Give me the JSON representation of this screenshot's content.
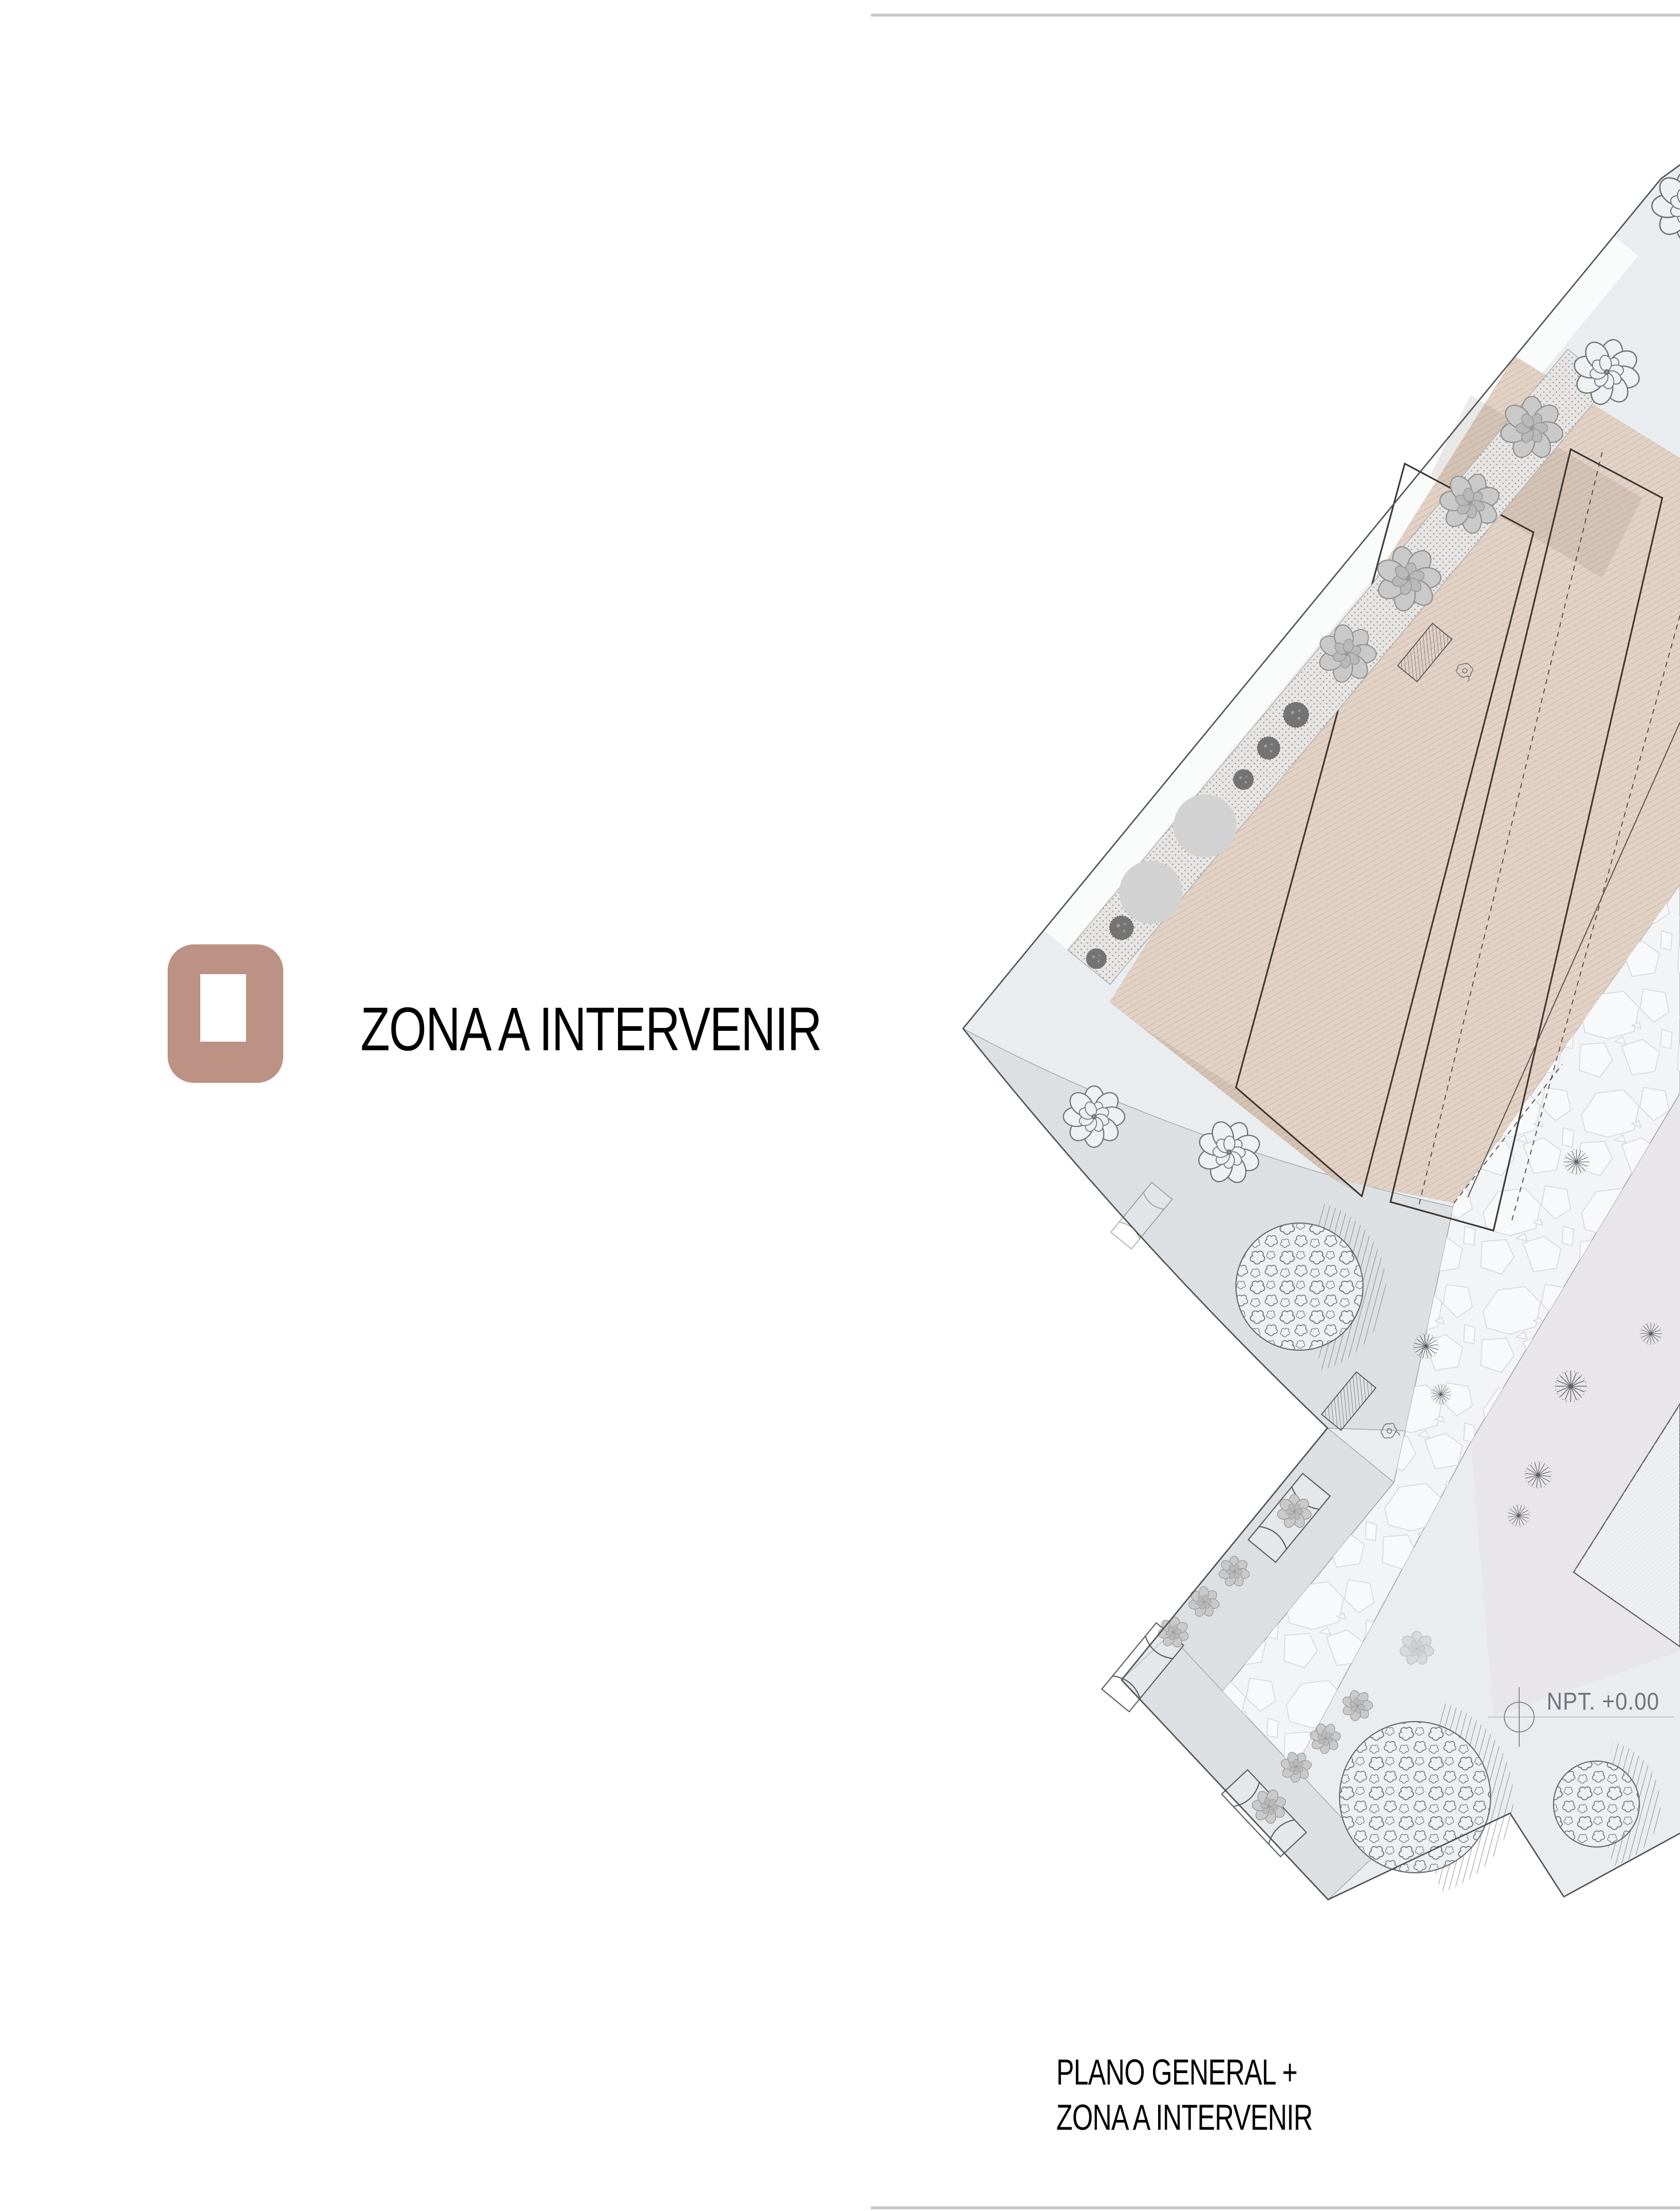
{
  "legend": {
    "zone_label": "ZONA A INTERVENIR",
    "swatch_color": "#bc9285"
  },
  "plan": {
    "npt_label": "NPT. +0.00"
  },
  "caption": {
    "line1": "PLANO GENERAL +",
    "line2": "ZONA A INTERVENIR"
  },
  "colors": {
    "accent": "#bc9285",
    "plaza": "#e9edf0",
    "walkway": "#dde0e3",
    "zone": "#e2d1c5",
    "pink": "#e8e6ea",
    "pebble": "#f2f4f6",
    "line": "#4d4f52",
    "labelgray": "#6f747a"
  }
}
